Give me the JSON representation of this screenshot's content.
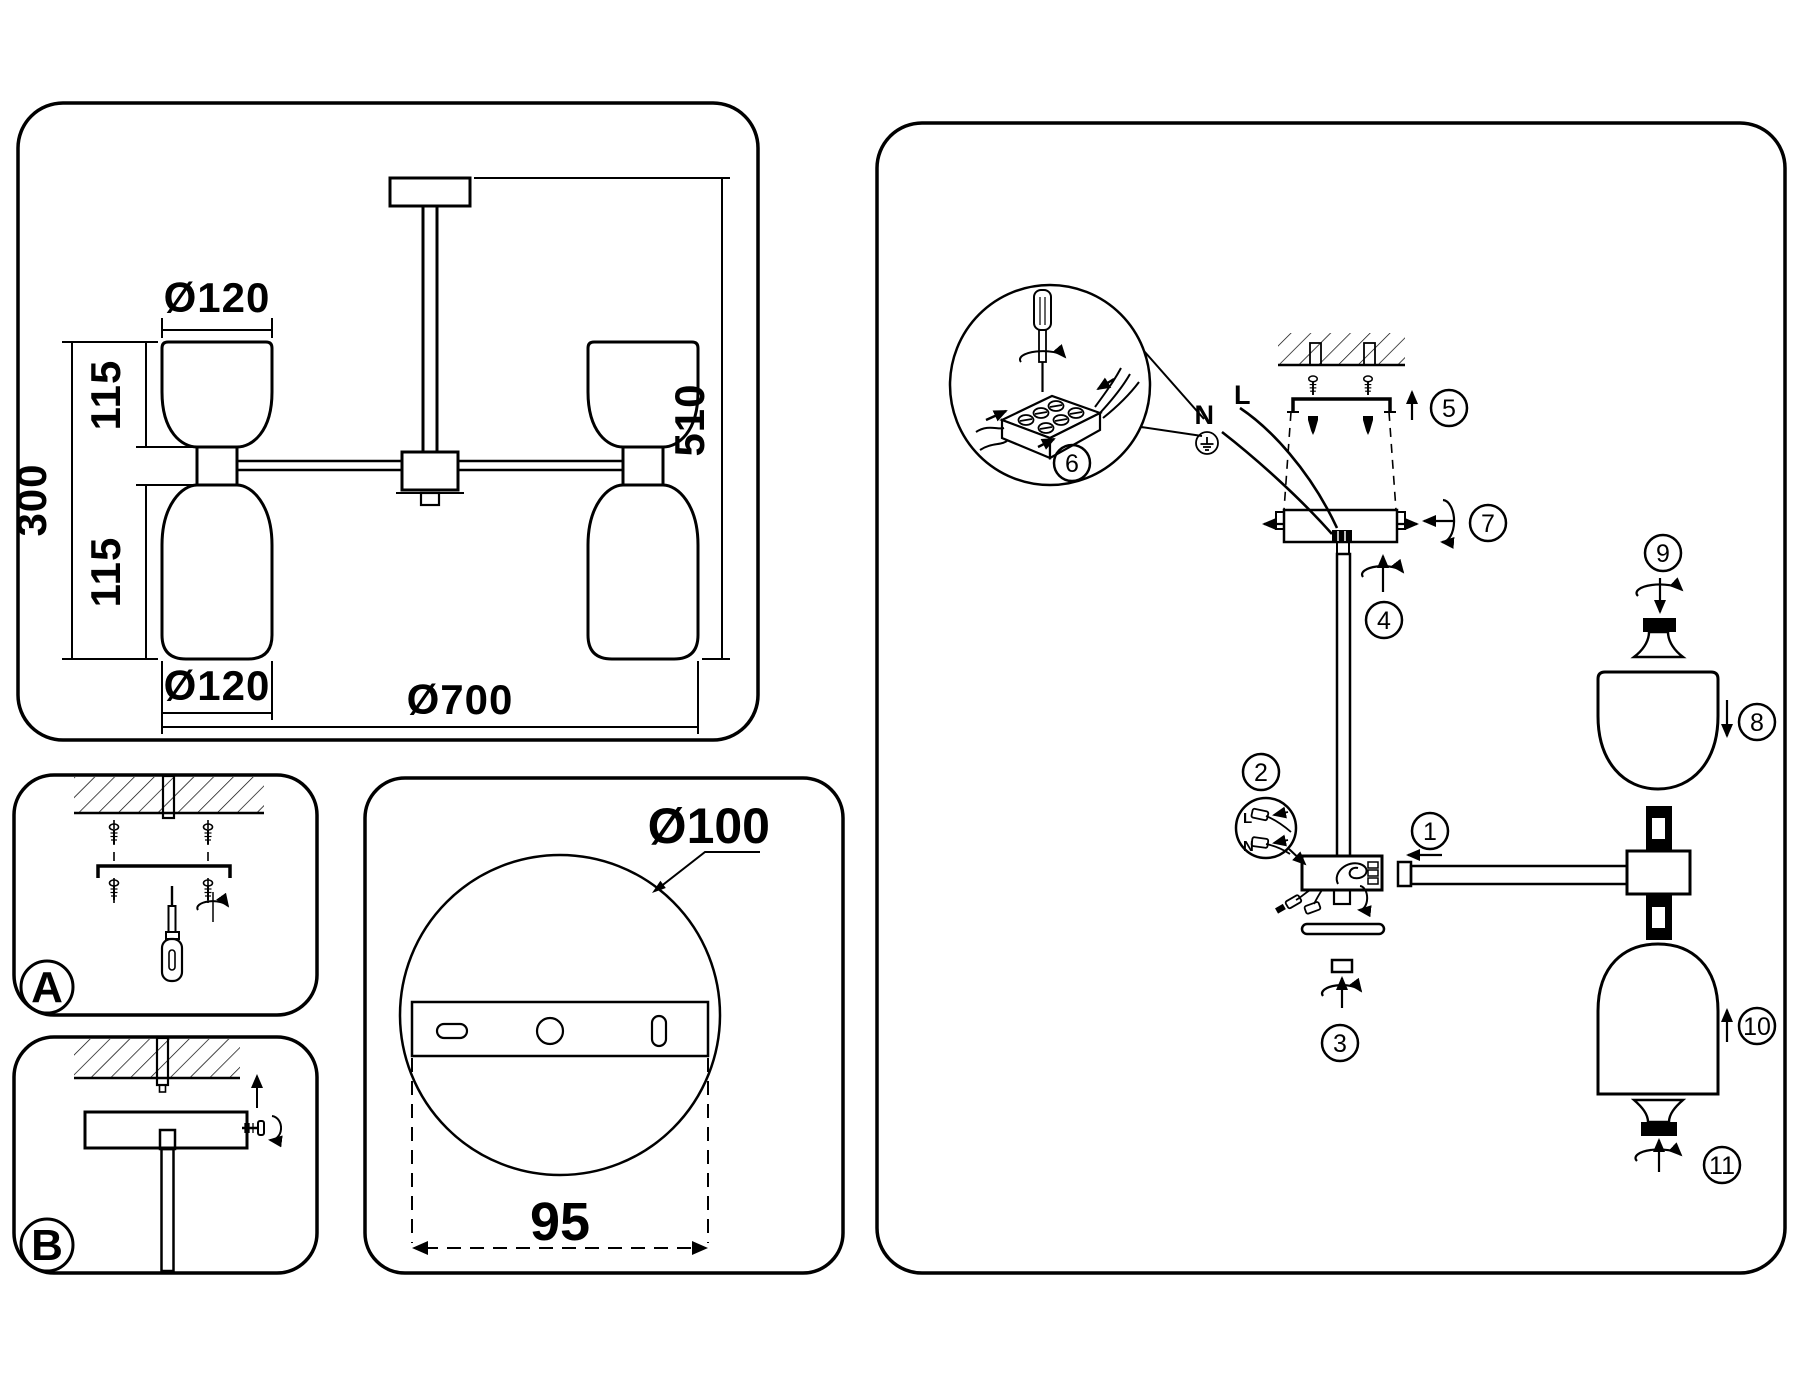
{
  "title": "ceiling-lamp-installation-diagram",
  "dimensions": {
    "shade_top_diameter": "Ø120",
    "shade_upper_height": "115",
    "shades_total_height": "300",
    "shade_lower_height": "115",
    "shade_bottom_diameter": "Ø120",
    "fixture_diameter": "Ø700",
    "fixture_height": "510",
    "canopy_diameter": "Ø100",
    "mount_hole_spacing": "95"
  },
  "mount_options": {
    "option_a": "A",
    "option_b": "B"
  },
  "wiring": {
    "neutral": "N",
    "line": "L",
    "ground_symbol": "earth-ground"
  },
  "steps": {
    "s1": "1",
    "s2": "2",
    "s3": "3",
    "s4": "4",
    "s5": "5",
    "s6": "6",
    "s7": "7",
    "s8": "8",
    "s9": "9",
    "s10": "10",
    "s11": "11"
  },
  "colors": {
    "line": "#000000",
    "background": "#ffffff"
  }
}
